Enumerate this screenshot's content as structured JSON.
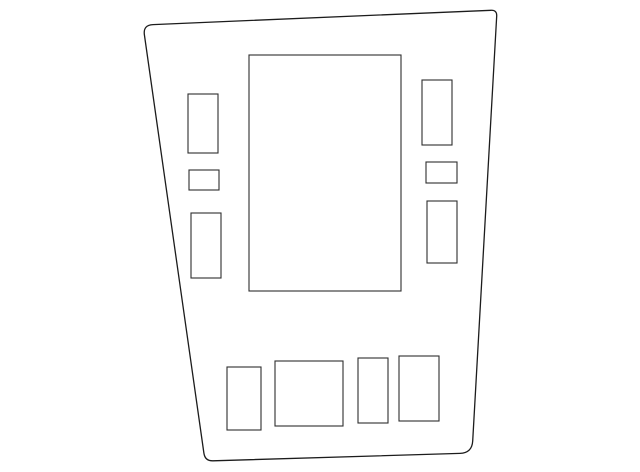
{
  "diagram": {
    "description": "Monochrome line-art parts diagram: tapered trim panel outline with rectangular cutouts",
    "canvas": {
      "width": 640,
      "height": 472,
      "background": "#ffffff"
    },
    "outline": {
      "name": "panel-outline",
      "stroke": "#1c1c1c",
      "stroke_width": 1.3,
      "fill": "#ffffff",
      "corners": {
        "top_left": [
          143,
          25
        ],
        "top_right": [
          497,
          10
        ],
        "bottom_right": [
          472,
          453
        ],
        "bottom_left": [
          205,
          461
        ]
      },
      "path": "M 153,24.6 L 491,10.3 Q 497,10 496.7,16 L 472.7,441 Q 472,453 460,453.4 L 213,460.8 Q 205,461 203.9,453.1 L 144.4,34.9 Q 143,25 153,24.6 Z"
    },
    "cutouts": {
      "stroke": "#2e2e2e",
      "stroke_width": 1.1,
      "fill": "#ffffff",
      "items": [
        {
          "name": "cutout-center-large",
          "x": 249,
          "y": 55,
          "w": 152,
          "h": 236
        },
        {
          "name": "cutout-left-top",
          "x": 188,
          "y": 94,
          "w": 30,
          "h": 59
        },
        {
          "name": "cutout-left-middle-small",
          "x": 189,
          "y": 170,
          "w": 30,
          "h": 20
        },
        {
          "name": "cutout-left-bottom",
          "x": 191,
          "y": 213,
          "w": 30,
          "h": 65
        },
        {
          "name": "cutout-right-top",
          "x": 422,
          "y": 80,
          "w": 30,
          "h": 65
        },
        {
          "name": "cutout-right-middle-small",
          "x": 426,
          "y": 162,
          "w": 31,
          "h": 21
        },
        {
          "name": "cutout-right-bottom",
          "x": 427,
          "y": 201,
          "w": 30,
          "h": 62
        },
        {
          "name": "cutout-bottom-row-1",
          "x": 227,
          "y": 367,
          "w": 34,
          "h": 63
        },
        {
          "name": "cutout-bottom-row-2",
          "x": 275,
          "y": 361,
          "w": 68,
          "h": 65
        },
        {
          "name": "cutout-bottom-row-3",
          "x": 358,
          "y": 358,
          "w": 30,
          "h": 65
        },
        {
          "name": "cutout-bottom-row-4",
          "x": 399,
          "y": 356,
          "w": 40,
          "h": 65
        }
      ]
    }
  }
}
